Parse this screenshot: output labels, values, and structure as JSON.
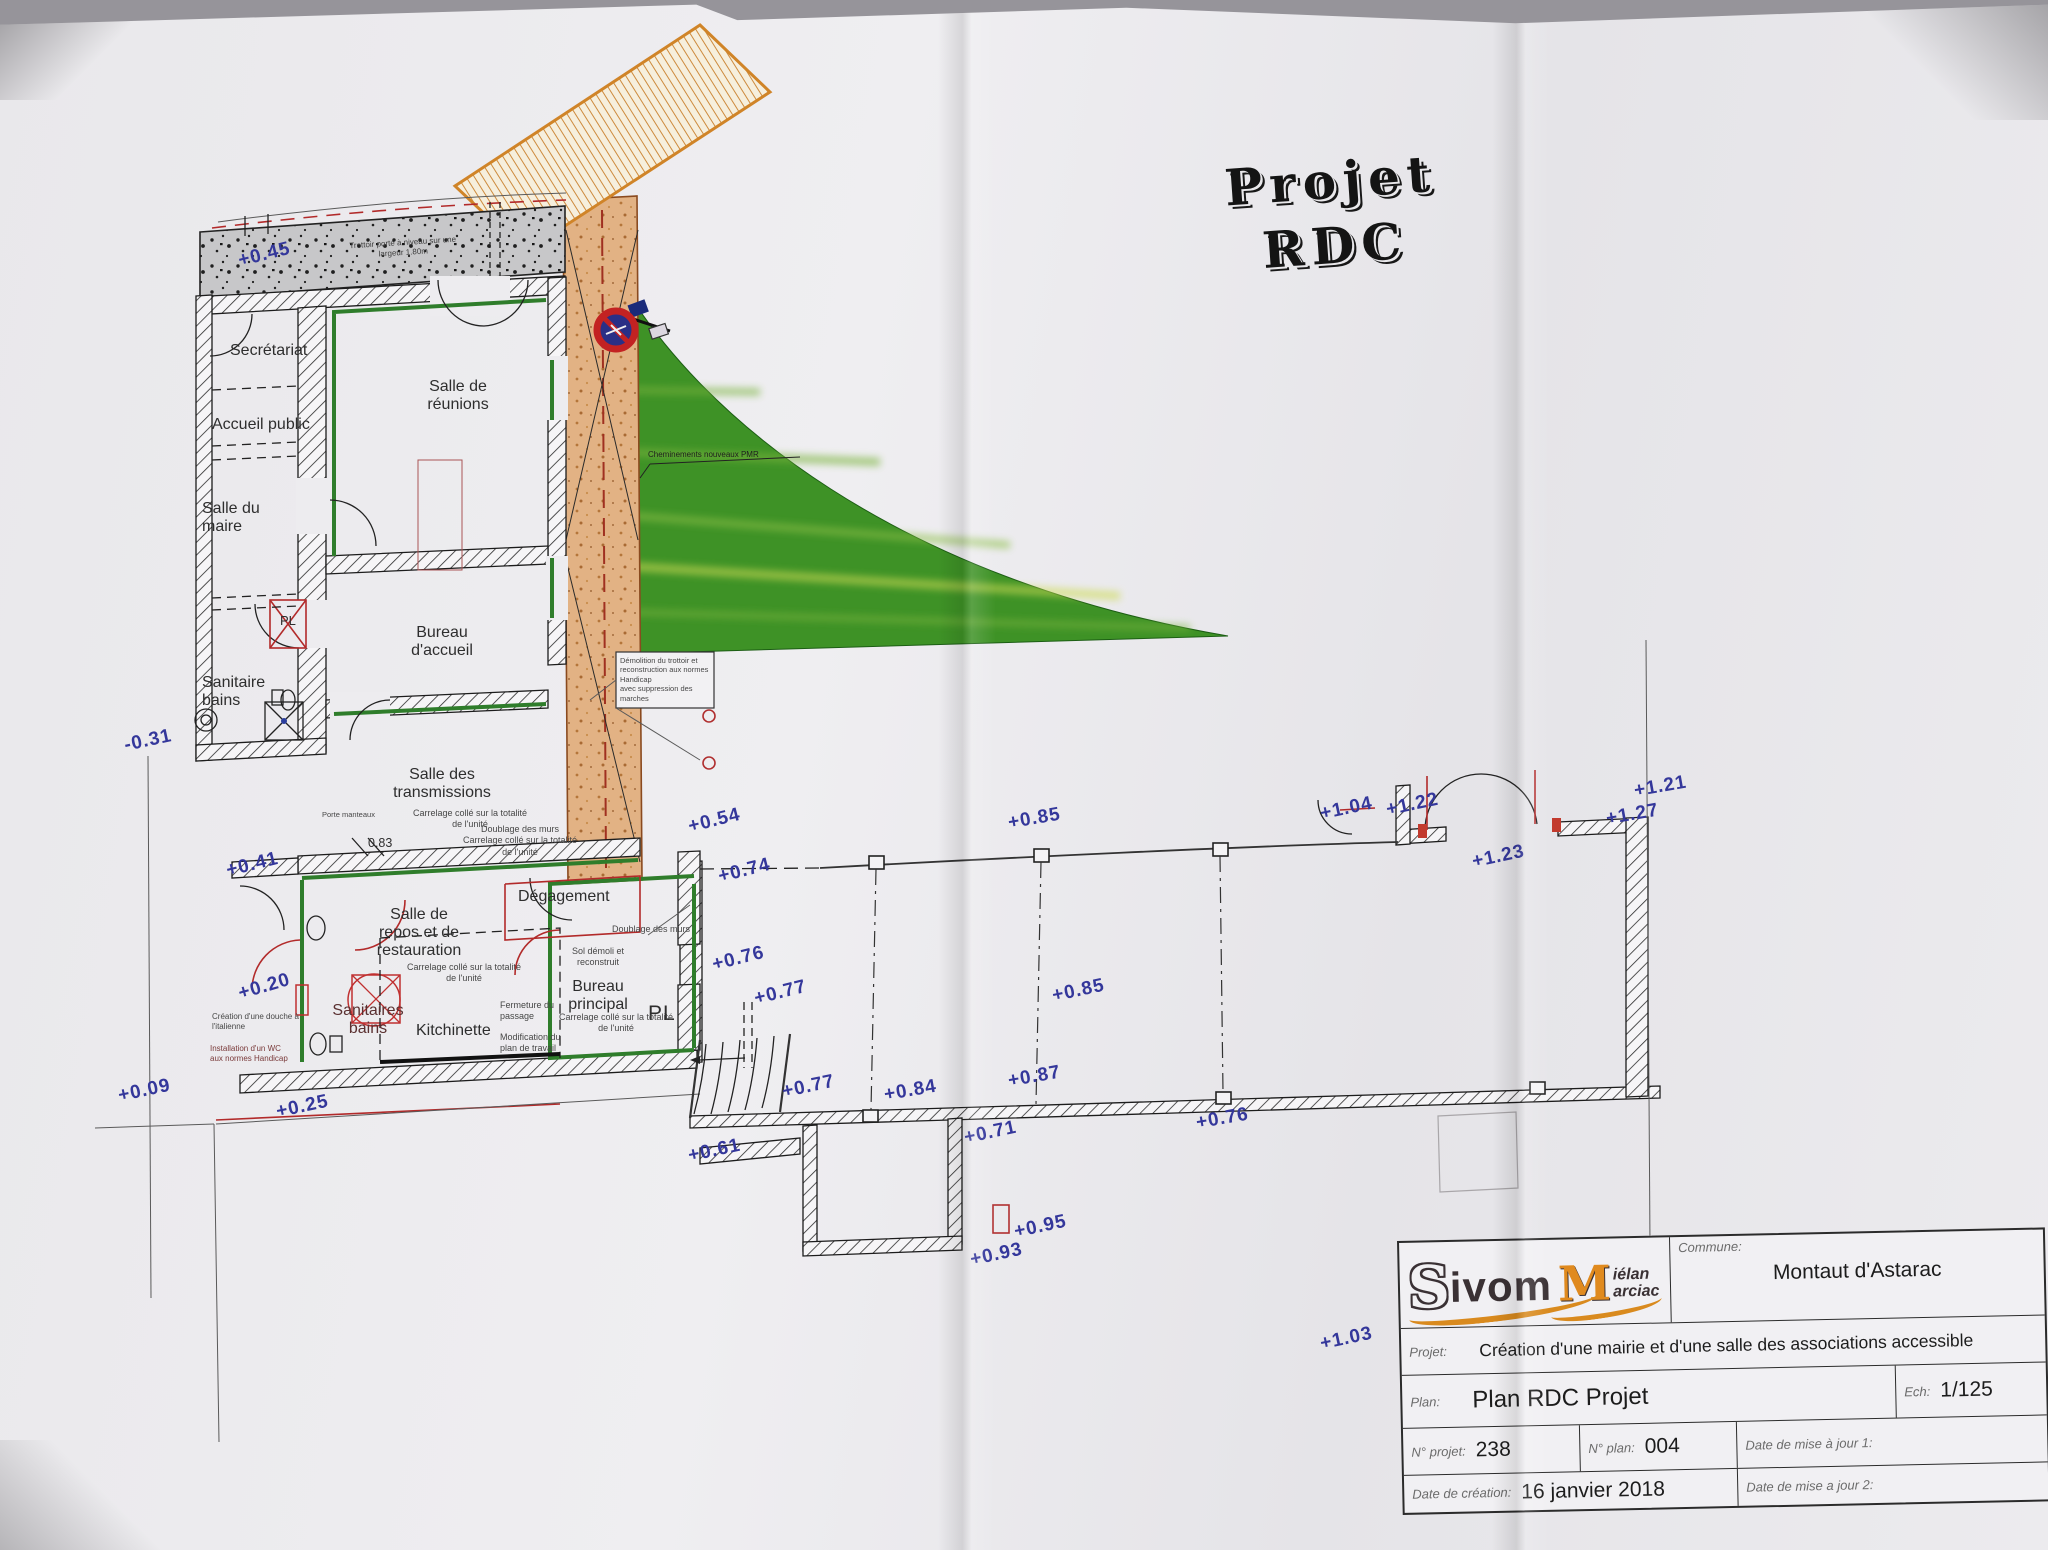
{
  "page": {
    "title": "Projet\nRDC"
  },
  "plan": {
    "rooms": {
      "secretariat": "Secrétariat",
      "accueil_public": "Accueil public",
      "salle_du_maire": "Salle du\nmaire",
      "salle_de_reunions": "Salle de\nréunions",
      "bureau_accueil": "Bureau\nd'accueil",
      "sanitaire_bains": "Sanitaire\nbains",
      "salle_des_transmissions": "Salle des\ntransmissions",
      "salle_de_repos": "Salle de\nrepos et de\nrestauration",
      "degagement": "Dégagement",
      "bureau_principal": "Bureau\nprincipal",
      "kitchinette": "Kitchinette",
      "sanitaires_bains": "Sanitaires\nbains",
      "placard": "PL",
      "placard_small": "PL"
    },
    "annotations": {
      "trottoir_band": "Trottoir porté à niveau sur une\nlargeur 1.80m",
      "porte_manteaux": "Porte manteaux",
      "carrelage_transmissions": "Carrelage collé sur la totalité\nde l'unité",
      "doublage_carrelage": "Doublage des murs\nCarrelage collé sur la totalité\nde l'unité",
      "carrelage_repos": "Carrelage collé sur la totalité\nde l'unité",
      "sol_demoli": "Sol démoli et\nreconstruit",
      "carrelage_bureau": "Carrelage collé sur la totalité\nde l'unité",
      "doublage_murs": "Doublage des murs",
      "fermeture_passage": "Fermeture du\npassage",
      "modification_plan": "Modification du\nplan de travail",
      "douche_italienne": "Création d'une douche à\nl'italienne",
      "wc_handicap": "Installation d'un WC\naux normes Handicap",
      "cheminements": "Cheminements nouveaux PMR",
      "demolition_trottoir": "Démolition du trottoir et\nreconstruction aux normes Handicap\navec suppression des marches",
      "largeur_porte": "0.83"
    },
    "elevations": [
      "+0.45",
      "-0.31",
      "+0.41",
      "+0.20",
      "+0.09",
      "+0.25",
      "+0.54",
      "+0.74",
      "+0.76",
      "+0.77",
      "+0.77",
      "+0.61",
      "+0.84",
      "+0.71",
      "+0.93",
      "+0.95",
      "+0.87",
      "+0.85",
      "+0.85",
      "+0.76",
      "+1.04",
      "+1.22",
      "+1.23",
      "+1.21",
      "+1.27",
      "+1.03"
    ]
  },
  "title_block": {
    "logo_s": "S",
    "logo_ivom": "ivom",
    "logo_m": "M",
    "logo_mielan": "iélan",
    "logo_marciac": "arciac",
    "commune_label": "Commune:",
    "commune_value": "Montaut d'Astarac",
    "projet_label": "Projet:",
    "projet_value": "Création d'une mairie et d'une salle des associations accessible",
    "plan_label": "Plan:",
    "plan_value": "Plan RDC Projet",
    "ech_label": "Ech:",
    "ech_value": "1/125",
    "num_projet_label": "N° projet:",
    "num_projet_value": "238",
    "num_plan_label": "N° plan:",
    "num_plan_value": "004",
    "maj1_label": "Date de mise à jour 1:",
    "creation_label": "Date de création:",
    "creation_value": "16 janvier 2018",
    "maj2_label": "Date de mise a jour 2:"
  },
  "colors": {
    "accent_orange": "#d98a2b",
    "grass_green": "#3f9427",
    "elevation_blue": "#34379b",
    "wall_red": "#b22a2a",
    "paper": "#ecebee"
  }
}
